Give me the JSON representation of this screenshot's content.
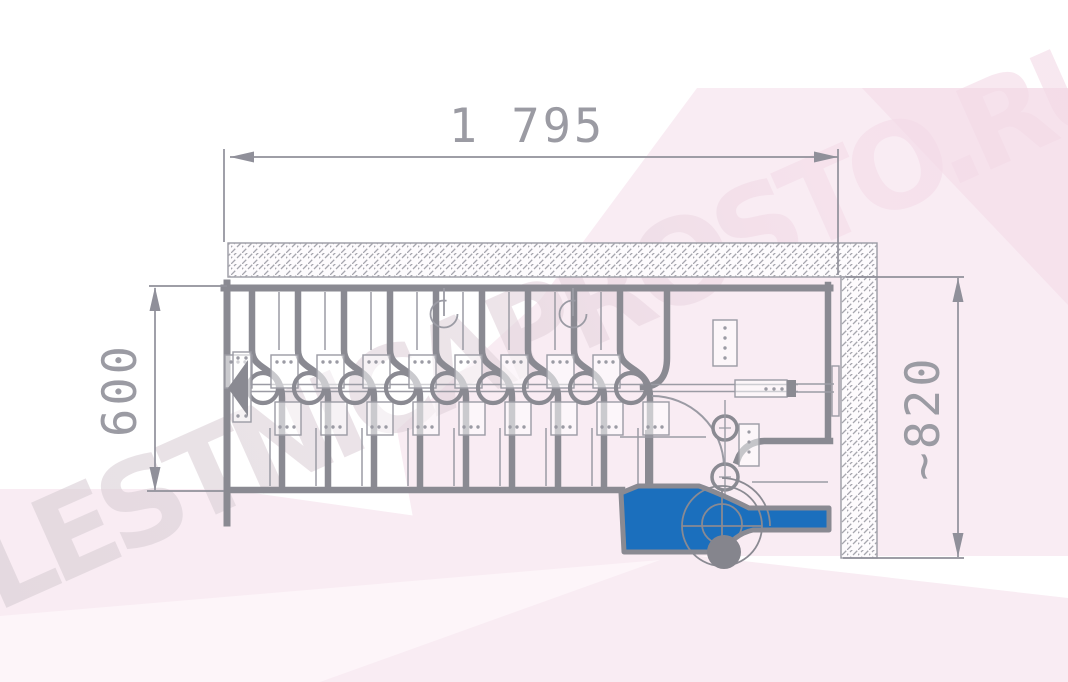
{
  "watermark": {
    "text": "LESTNICAPROSTO.RU"
  },
  "dimensions": {
    "top_width": {
      "label": "1 795"
    },
    "left_depth": {
      "label": "600"
    },
    "right_height": {
      "label": "~820"
    }
  },
  "drawing": {
    "kind": "modular-staircase-plan-top-view",
    "highlighted_bottom_tread": "blue"
  },
  "colors": {
    "thick_line": "#8a8a92",
    "thin_line": "#9b9ba4",
    "hatch": "#a6a6ae",
    "dimension": "#90909a",
    "highlight_blue": "#1b6fbd",
    "pink_main": "#f9ecf3",
    "pink_deep": "#f6e2ec",
    "pink_light": "#fdf5f9"
  }
}
